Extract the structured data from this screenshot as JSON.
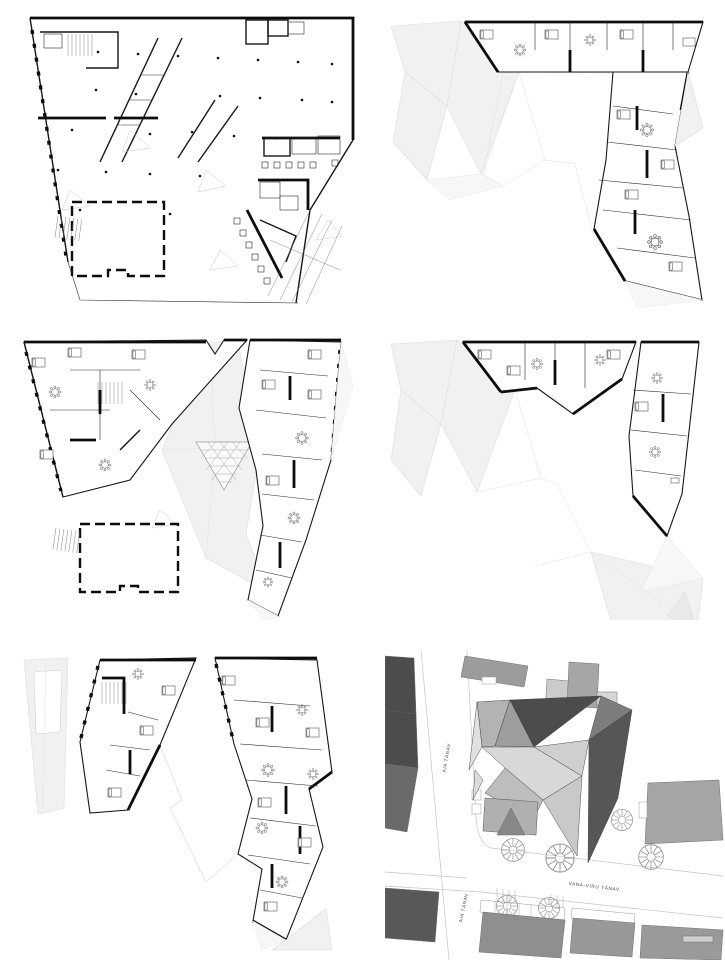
{
  "sheet": {
    "background": "#ffffff",
    "drawing_type": "architectural floor plans and site plan"
  },
  "site_plan": {
    "street_labels": {
      "aia_upper": "AIA TÄNAV",
      "aia_lower": "AIA TÄNAV",
      "vana_viru": "VANA-VIRU TÄNAV"
    }
  },
  "palette": {
    "plan_line": "#1a1a1a",
    "roof_fill": "#f1f1f1",
    "roof_edge": "#dedede",
    "site_building_dark": "#4c4c4c",
    "site_building_dark2": "#585858",
    "site_building_mid": "#9c9c9c",
    "site_building_light": "#cbcbcb",
    "road_line": "#c4c4c4",
    "facet_charcoal": "#4c4c4c",
    "facet_dark": "#565656",
    "facet_mid": "#b3b3b3",
    "facet_mid2": "#9d9d9d",
    "facet_pale": "#d8d8d8",
    "facet_pale2": "#c9c9c9",
    "tree_line": "#8a8a8a"
  }
}
